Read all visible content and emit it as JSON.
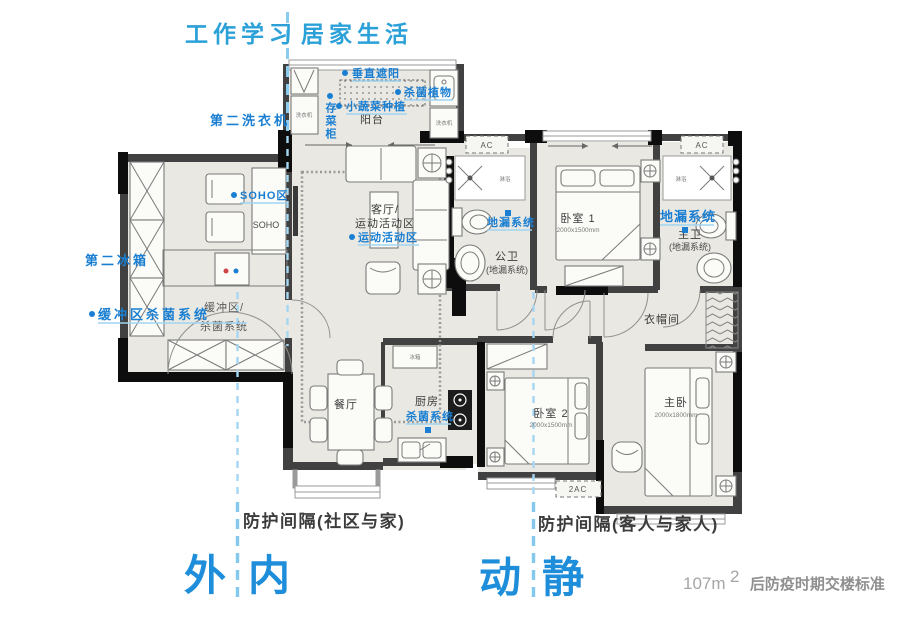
{
  "header": {
    "work_study": "工作学习",
    "home_life": "居家生活"
  },
  "annotations": {
    "vertical_shading": "垂直遮阳",
    "sterilizing_plants": "杀菌植物",
    "vegetable_planting": "小蔬菜种植",
    "vegetable_cabinet": "存菜柜",
    "second_washer": "第二洗衣机",
    "soho_zone": "SOHO区",
    "second_fridge": "第二冰箱",
    "buffer_sterilizing": "缓冲区杀菌系统",
    "sports_zone": "运动活动区",
    "floor_drain_public": "地漏系统",
    "floor_drain_master": "地漏系统",
    "kitchen_sterilizing": "杀菌系统"
  },
  "rooms": {
    "balcony": "阳台",
    "soho": "SOHO",
    "living_line1": "客厅/",
    "living_line2": "运动活动区",
    "buffer_line1": "缓冲区/",
    "buffer_line2": "杀菌系统",
    "dining": "餐厅",
    "kitchen": "厨房",
    "public_bath": "公卫",
    "public_bath_note": "(地漏系统)",
    "master_bath": "主卫",
    "master_bath_note": "(地漏系统)",
    "bedroom1": "卧室 1",
    "bedroom1_dims": "2000x1500mm",
    "bedroom2": "卧室 2",
    "bedroom2_dims": "2000x1500mm",
    "master_bedroom": "主卧",
    "master_bedroom_dims": "2000x1800mm",
    "closet": "衣帽间",
    "shower_public": "淋浴",
    "shower_master": "淋浴"
  },
  "appliances": {
    "washer_balcony_left": "洗衣机",
    "washer_balcony_right": "洗衣机",
    "fridge": "冰箱"
  },
  "hvac": {
    "ac_left": "AC",
    "ac_right": "AC",
    "ac_bottom": "2AC"
  },
  "footer": {
    "barrier_community": "防护间隔(社区与家)",
    "barrier_guest": "防护间隔(客人与家人)",
    "zone_outside": "外",
    "zone_inside": "内",
    "zone_active": "动",
    "zone_quiet": "静",
    "area_value": "107m",
    "area_sup": "2",
    "area_note": "后防疫时期交楼标准"
  },
  "colors": {
    "annotation_blue": "#1a7fd2",
    "header_blue": "#2ba1d8",
    "zone_blue": "#1e8edb",
    "divider_blue": "#8ccbf0",
    "wall_dark": "#414141",
    "wall_black": "#0d0d0d",
    "floor_fill": "#e9e8e2"
  }
}
